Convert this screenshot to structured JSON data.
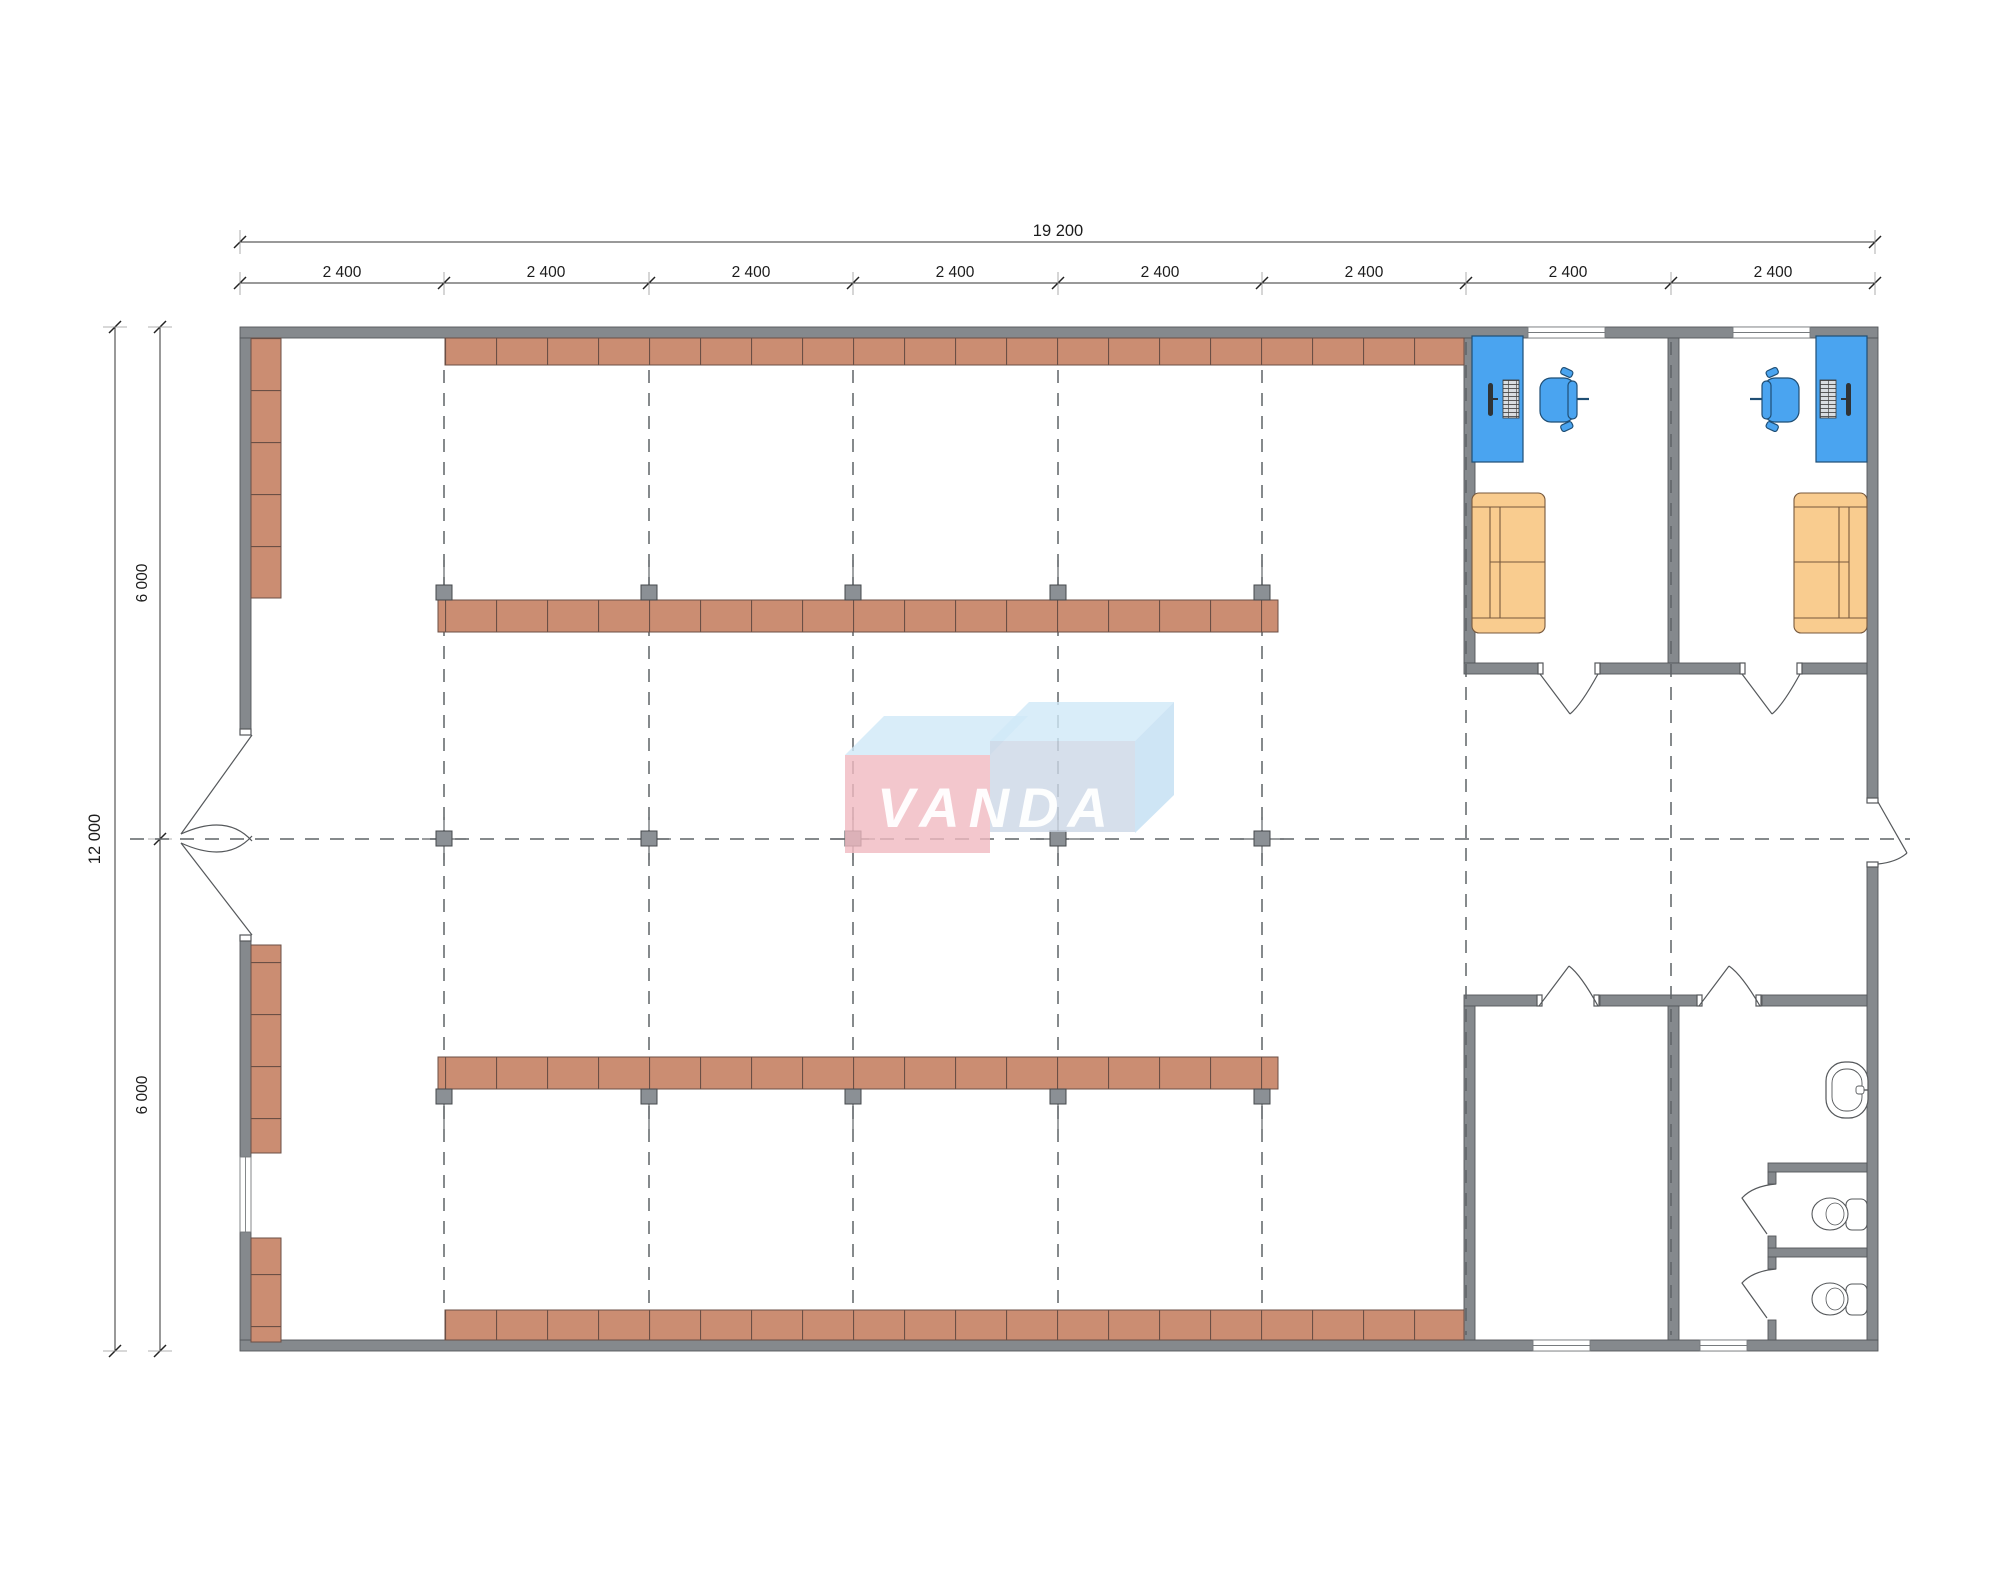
{
  "watermark": {
    "text": "VANDA",
    "colors": {
      "left_box": "#F0B9C0",
      "right_box": "#CCD7E6",
      "top_faces": "#CFE9F8",
      "letters": "#FFFFFF"
    }
  },
  "dimensions": {
    "top_total": {
      "label": "19 200"
    },
    "top_segments": [
      {
        "label": "2 400"
      },
      {
        "label": "2 400"
      },
      {
        "label": "2 400"
      },
      {
        "label": "2 400"
      },
      {
        "label": "2 400"
      },
      {
        "label": "2 400"
      },
      {
        "label": "2 400"
      },
      {
        "label": "2 400"
      }
    ],
    "left_total": {
      "label": "12 000"
    },
    "left_segments": [
      {
        "label": "6 000"
      },
      {
        "label": "6 000"
      }
    ]
  },
  "plan": {
    "grid": {
      "bays_horizontal": 8,
      "bay_size_label": "2 400",
      "column_markers": 15
    },
    "rooms": [
      {
        "name": "sales-hall",
        "furniture": [
          "perimeter-shelving",
          "island-shelving-row",
          "island-shelving-row",
          "double-entrance-door"
        ]
      },
      {
        "name": "office-1",
        "furniture": [
          "desk",
          "computer",
          "office-chair",
          "sofa",
          "window",
          "door"
        ]
      },
      {
        "name": "office-2",
        "furniture": [
          "desk",
          "computer",
          "office-chair",
          "sofa",
          "window",
          "door"
        ]
      },
      {
        "name": "storage-room",
        "furniture": [
          "door",
          "window"
        ]
      },
      {
        "name": "restroom",
        "furniture": [
          "sink",
          "toilet",
          "toilet",
          "stall",
          "stall",
          "door",
          "window"
        ]
      }
    ],
    "colors": {
      "wall": "#85898D",
      "shelving": "#CB8D72",
      "desk_and_chair": "#4AA4F0",
      "sofa": "#F9CC8F",
      "grid_line": "#5F6367"
    }
  }
}
